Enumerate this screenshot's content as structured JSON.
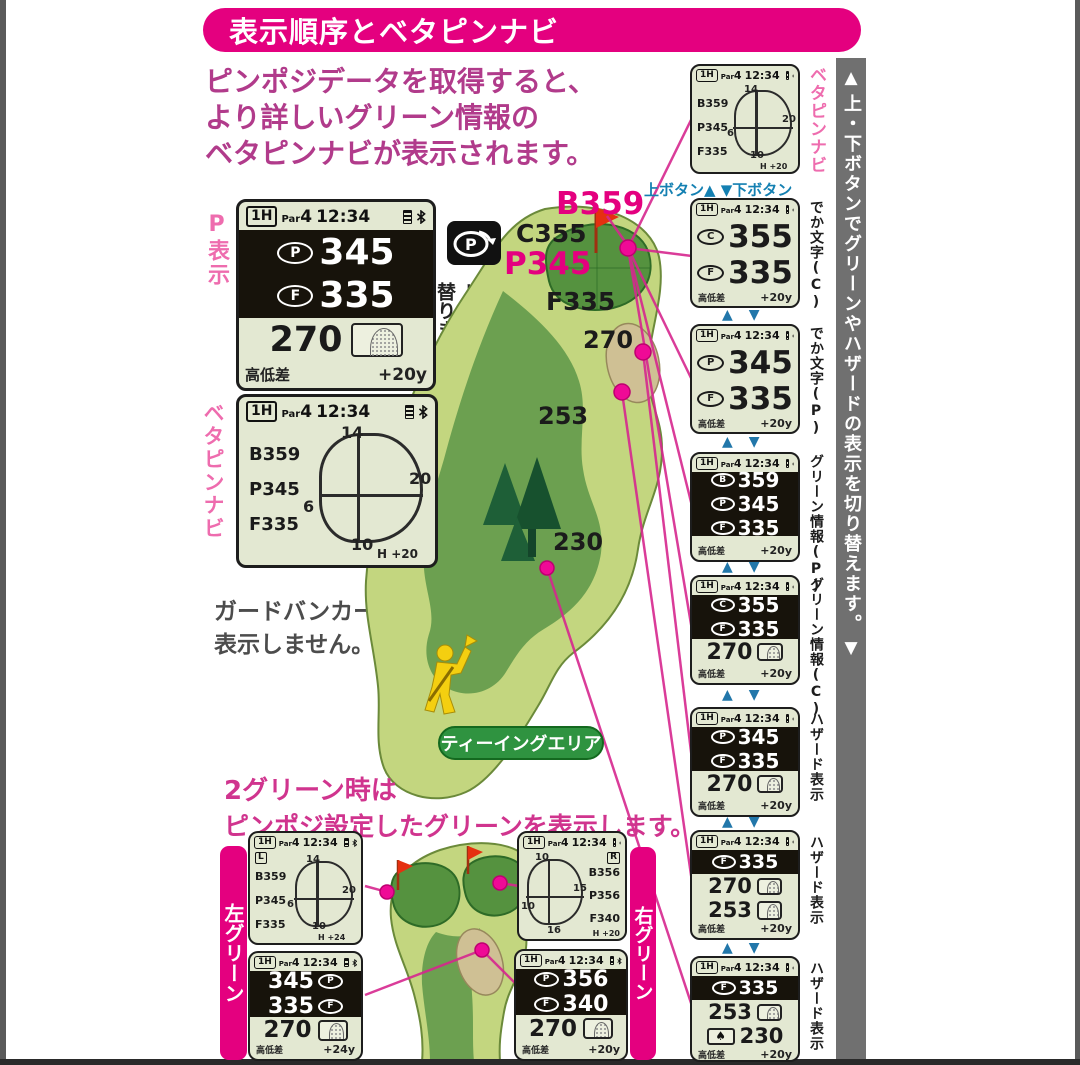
{
  "banner": {
    "title": "表示順序とベタピンナビ"
  },
  "intro": {
    "line1": "ピンポジデータを取得すると、",
    "line2": "より詳しいグリーン情報の",
    "line3": "ベタピンナビが表示されます。"
  },
  "common": {
    "hole": "1H",
    "par": "Par",
    "par_num": "4",
    "time": "12:34",
    "elev_label": "高低差"
  },
  "colors": {
    "accent_pink": "#e4007f",
    "lcd_bg": "#e3e8d2",
    "bar_gray": "#707070",
    "teal": "#1480b2",
    "rough_green": "#c3d67f",
    "fairway_green": "#6ca050",
    "putting_green": "#55923f",
    "bunker_tan": "#cfc094"
  },
  "p_display": {
    "label": "P表示",
    "rows": [
      {
        "icon": "P",
        "value": "345"
      },
      {
        "icon": "F",
        "value": "335"
      }
    ],
    "mid_value": "270",
    "footer_value": "+20y"
  },
  "pin_switch": {
    "icon_letter": "P",
    "note": "ピンまでの距離に切り替ります。"
  },
  "betapin": {
    "label": "ベタピンナビ",
    "values": [
      "B359",
      "P345",
      "F335"
    ],
    "top": "14",
    "right": "20",
    "left": "6",
    "bottom": "10",
    "elev": "H +20"
  },
  "bunker_note": {
    "line1": "ガードバンカーは",
    "line2": "表示しません。"
  },
  "map": {
    "b_label": "B359",
    "c_label": "C355",
    "p_label": "P345",
    "f_label": "F335",
    "dist1": "270",
    "dist2": "253",
    "dist3": "230",
    "teeing_label": "ティーイングエリア"
  },
  "button_note": "上ボタン▲ ▼下ボタン",
  "sidebar": {
    "up": "▲",
    "text": "上・下ボタンでグリーンやハザードの表示を切り替えます。",
    "down": "▼"
  },
  "right_screens": [
    {
      "label": "ベタピンナビ",
      "values": [
        "B359",
        "P345",
        "F335"
      ],
      "top": "14",
      "right": "20",
      "left": "6",
      "bottom": "10",
      "elev": "H +20"
    },
    {
      "label": "でか文字(C)",
      "rows": [
        {
          "icon": "C",
          "value": "355"
        },
        {
          "icon": "F",
          "value": "335"
        }
      ],
      "footer_value": "+20y"
    },
    {
      "label": "でか文字(P)",
      "rows": [
        {
          "icon": "P",
          "value": "345"
        },
        {
          "icon": "F",
          "value": "335"
        }
      ],
      "footer_value": "+20y"
    },
    {
      "label": "グリーン情報(P)",
      "dark_rows": [
        {
          "icon": "B",
          "value": "359"
        },
        {
          "icon": "P",
          "value": "345"
        },
        {
          "icon": "F",
          "value": "335"
        }
      ],
      "footer_value": "+20y"
    },
    {
      "label": "グリーン情報(C)",
      "dark_rows": [
        {
          "icon": "C",
          "value": "355"
        },
        {
          "icon": "F",
          "value": "335"
        }
      ],
      "mid_rows": [
        {
          "value": "270",
          "icon": "green"
        }
      ],
      "footer_value": "+20y"
    },
    {
      "label": "ハザード表示",
      "dark_rows": [
        {
          "icon": "P",
          "value": "345"
        },
        {
          "icon": "F",
          "value": "335"
        }
      ],
      "mid_rows": [
        {
          "value": "270",
          "icon": "bunker"
        }
      ],
      "footer_value": "+20y"
    },
    {
      "label": "ハザード表示",
      "dark_rows": [
        {
          "icon": "F",
          "value": "335"
        }
      ],
      "mid_rows": [
        {
          "value": "270",
          "icon": "bunker"
        },
        {
          "value": "253",
          "icon": "bunker"
        }
      ],
      "footer_value": "+20y"
    },
    {
      "label": "ハザード表示",
      "dark_rows": [
        {
          "icon": "F",
          "value": "335"
        }
      ],
      "mid_rows": [
        {
          "value": "253",
          "icon": "bunker"
        },
        {
          "value": "230",
          "icon": "tree"
        }
      ],
      "footer_value": "+20y"
    }
  ],
  "two_green": {
    "line1": "2グリーン時は",
    "line2": "ピンポジ設定したグリーンを表示します。",
    "left_label": "左グリーン",
    "right_label": "右グリーン",
    "l1": {
      "badge": "L",
      "values": [
        "B359",
        "P345",
        "F335"
      ],
      "top": "14",
      "right": "20",
      "left": "6",
      "bottom": "10",
      "elev": "H +24"
    },
    "l2": {
      "dark_rows": [
        {
          "value": "345",
          "icon": "P"
        },
        {
          "value": "335",
          "icon": "F"
        }
      ],
      "mid_value": "270",
      "footer_value": "+24y"
    },
    "r1": {
      "badge": "R",
      "values": [
        "B356",
        "P356",
        "F340"
      ],
      "top": "10",
      "right": "15",
      "left": "10",
      "bottom": "16",
      "elev": "H +20"
    },
    "r2": {
      "dark_rows": [
        {
          "icon": "P",
          "value": "356"
        },
        {
          "icon": "F",
          "value": "340"
        }
      ],
      "mid_value": "270",
      "footer_value": "+20y"
    }
  }
}
